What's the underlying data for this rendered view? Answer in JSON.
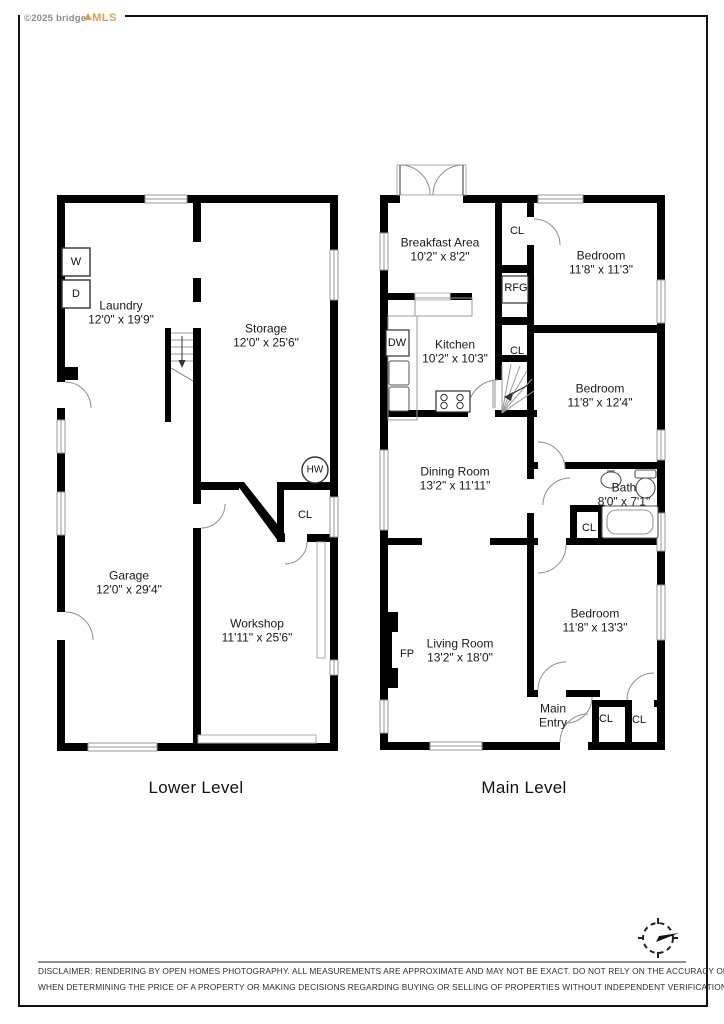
{
  "watermark": {
    "copyright": "©2025 bridge",
    "brand": "MLS"
  },
  "lower": {
    "title": "Lower Level",
    "rooms": {
      "laundry": {
        "name": "Laundry",
        "dims": "12'0\" x 19'9\""
      },
      "storage": {
        "name": "Storage",
        "dims": "12'0\" x 25'6\""
      },
      "garage": {
        "name": "Garage",
        "dims": "12'0\" x 29'4\""
      },
      "workshop": {
        "name": "Workshop",
        "dims": "11'11\" x 25'6\""
      }
    },
    "fixtures": {
      "washer": "W",
      "dryer": "D",
      "water_heater": "HW",
      "closet": "CL"
    }
  },
  "main": {
    "title": "Main Level",
    "rooms": {
      "breakfast": {
        "name": "Breakfast Area",
        "dims": "10'2\" x 8'2\""
      },
      "kitchen": {
        "name": "Kitchen",
        "dims": "10'2\" x 10'3\""
      },
      "dining": {
        "name": "Dining Room",
        "dims": "13'2\" x 11'11\""
      },
      "living": {
        "name": "Living Room",
        "dims": "13'2\" x 18'0\""
      },
      "bedroom1": {
        "name": "Bedroom",
        "dims": "11'8\" x 11'3\""
      },
      "bedroom2": {
        "name": "Bedroom",
        "dims": "11'8\" x 12'4\""
      },
      "bedroom3": {
        "name": "Bedroom",
        "dims": "11'8\" x 13'3\""
      },
      "bath": {
        "name": "Bath",
        "dims": "8'0\" x 7'1\""
      },
      "entry": {
        "name": "Main Entry"
      }
    },
    "fixtures": {
      "dishwasher": "DW",
      "refrigerator": "RFG",
      "fireplace": "FP",
      "closet_hall": "CL",
      "closet_mid": "CL",
      "closet_bath": "CL",
      "closet_entry_1": "CL",
      "closet_entry_2": "CL"
    }
  },
  "footer": {
    "line1": "DISCLAIMER: RENDERING BY OPEN HOMES PHOTOGRAPHY. ALL MEASUREMENTS ARE APPROXIMATE AND MAY NOT BE EXACT. DO NOT RELY ON THE ACCURACY OF THIS FLOOR PLAN",
    "line2": "WHEN DETERMINING THE PRICE OF A PROPERTY OR MAKING DECISIONS REGARDING BUYING OR SELLING OF PROPERTIES WITHOUT INDEPENDENT VERIFICATION."
  },
  "colors": {
    "wall": "#000000",
    "brand": "#dca14f"
  }
}
